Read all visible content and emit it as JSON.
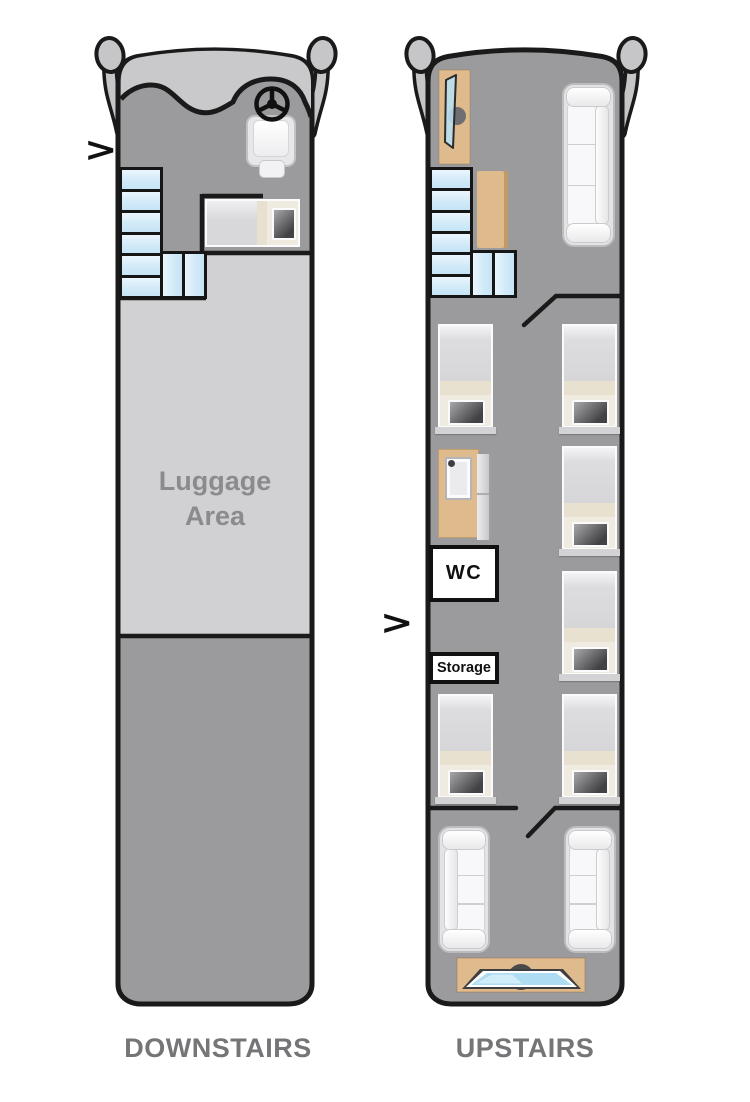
{
  "diagram": {
    "type": "bus-floor-plan",
    "floors": {
      "downstairs": {
        "title": "DOWNSTAIRS",
        "luggage_label": "Luggage Area",
        "entrance_arrow": ">",
        "visible_items": [
          "side-mirrors",
          "windshield",
          "steering-wheel",
          "driver-seat",
          "stairs",
          "crew-bunk",
          "luggage-area",
          "rear-floor-area"
        ]
      },
      "upstairs": {
        "title": "UPSTAIRS",
        "wc_label": "WC",
        "storage_label": "Storage",
        "entrance_arrow": ">",
        "visible_items": [
          "side-mirrors",
          "entry-door",
          "stairs",
          "cabinet",
          "front-sofa",
          "shower",
          "wc-room",
          "storage-box",
          "six-beds",
          "two-rear-sofas",
          "rear-screen"
        ]
      }
    },
    "colors": {
      "floor_gray": "#9b9b9d",
      "luggage_gray": "#d1d1d3",
      "windshield_gray": "#c9c9cb",
      "mirror_gray": "#c6c6c8",
      "stairs_blue": "#d2eaf8",
      "wood_tan": "#deba8c",
      "blanket_beige": "#e9e1cf",
      "pillow_dark": "#424244",
      "couch_white": "#f8f8fa",
      "outline_black": "#1a1a1a",
      "label_gray": "#757578",
      "screen_blue": "#aedcf2"
    }
  }
}
